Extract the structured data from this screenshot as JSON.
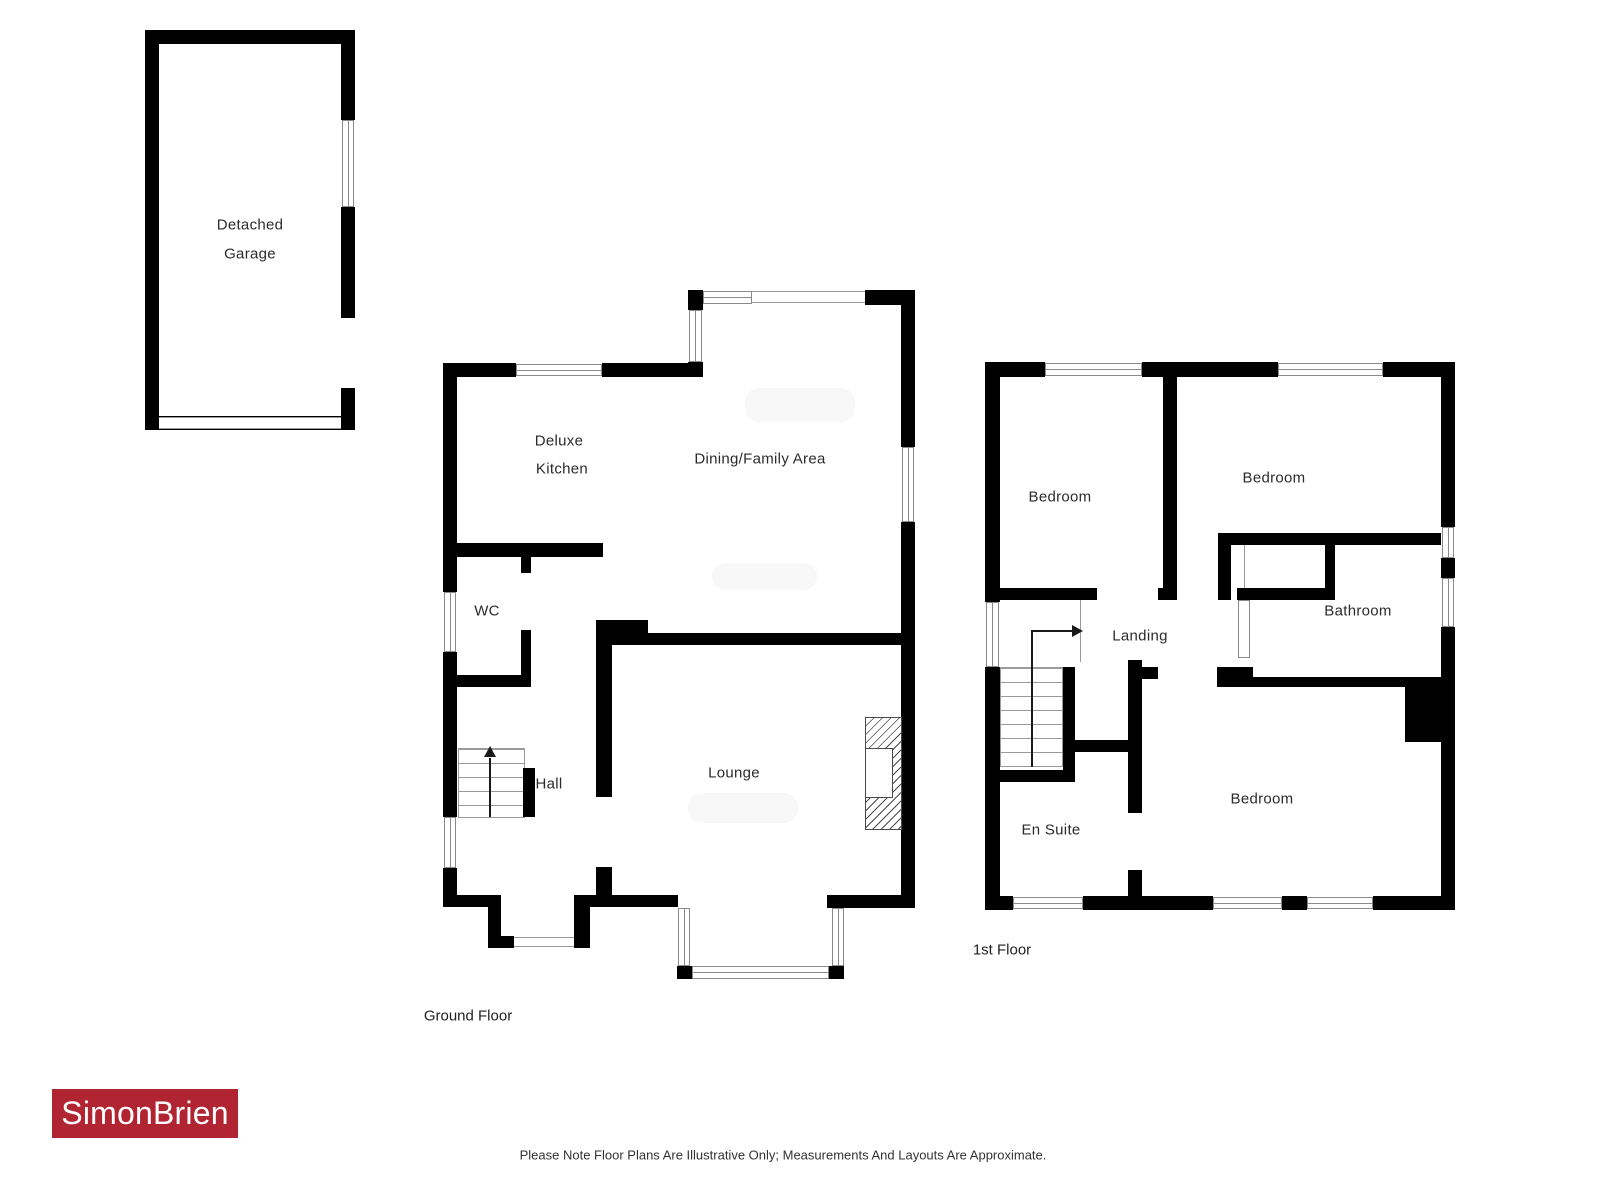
{
  "colors": {
    "wall": "#000000",
    "window_frame": "#8a8a8a",
    "brand_red": "#b12532",
    "label_text": "#2b2b2b"
  },
  "garage": {
    "line1": "Detached",
    "line2": "Garage"
  },
  "ground_floor": {
    "title": "Ground Floor",
    "kitchen_line1": "Deluxe",
    "kitchen_line2": "Kitchen",
    "dining": "Dining/Family Area",
    "wc": "WC",
    "hall": "Hall",
    "lounge": "Lounge"
  },
  "first_floor": {
    "title": "1st Floor",
    "bedroom_top_left": "Bedroom",
    "bedroom_top_right": "Bedroom",
    "bathroom": "Bathroom",
    "landing": "Landing",
    "en_suite": "En Suite",
    "bedroom_bottom": "Bedroom"
  },
  "footer": {
    "logo_text": "SimonBrien",
    "disclaimer": "Please Note Floor Plans Are Illustrative Only; Measurements And Layouts Are Approximate."
  }
}
